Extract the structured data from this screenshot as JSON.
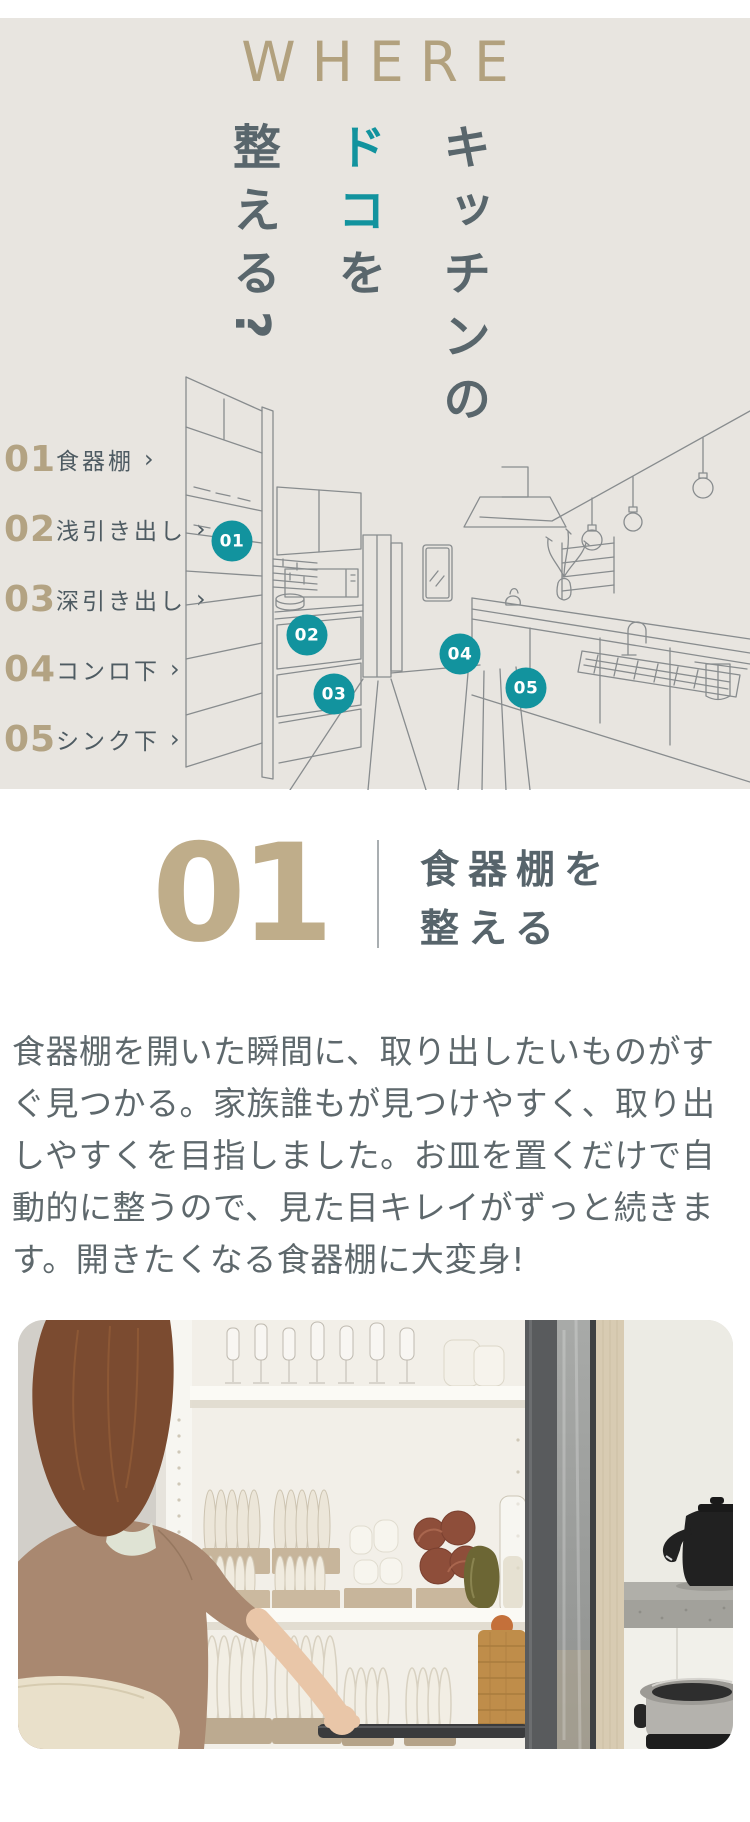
{
  "hero": {
    "eyebrow": "WHERE",
    "headline": {
      "columns": [
        {
          "segments": [
            {
              "text": "キッチンの",
              "accent": false
            }
          ]
        },
        {
          "segments": [
            {
              "text": "ドコ",
              "accent": true
            },
            {
              "text": "を",
              "accent": false
            }
          ]
        },
        {
          "segments": [
            {
              "text": "整える?",
              "accent": false
            }
          ]
        }
      ]
    },
    "menu_arrow": "›",
    "menu": [
      {
        "num": "01",
        "label": "食器棚"
      },
      {
        "num": "02",
        "label": "浅引き出し"
      },
      {
        "num": "03",
        "label": "深引き出し"
      },
      {
        "num": "04",
        "label": "コンロ下"
      },
      {
        "num": "05",
        "label": "シンク下"
      }
    ],
    "markers": [
      {
        "label": "01"
      },
      {
        "label": "02"
      },
      {
        "label": "03"
      },
      {
        "label": "04"
      },
      {
        "label": "05"
      }
    ]
  },
  "feature": {
    "number": "01",
    "title_line1": "食器棚を",
    "title_line2": "整える",
    "body": "食器棚を開いた瞬間に、取り出したいものがすぐ見つかる。家族誰もが見つけやすく、取り出しやすくを目指しました。お皿を置くだけで自動的に整うので、見た目キレイがずっと続きます。開きたくなる食器棚に大変身!"
  },
  "photo": {
    "description": "後ろ姿の女性がスライド扉の食器棚を開けている写真。棚にはグラス・皿・ボウルが整頓され、右手前に黒いケトルと炊飯器が見える。"
  },
  "colors": {
    "accent_teal": "#12939e",
    "tan": "#b2a17e",
    "slate": "#59666c",
    "hero_bg": "#e8e5e0"
  }
}
